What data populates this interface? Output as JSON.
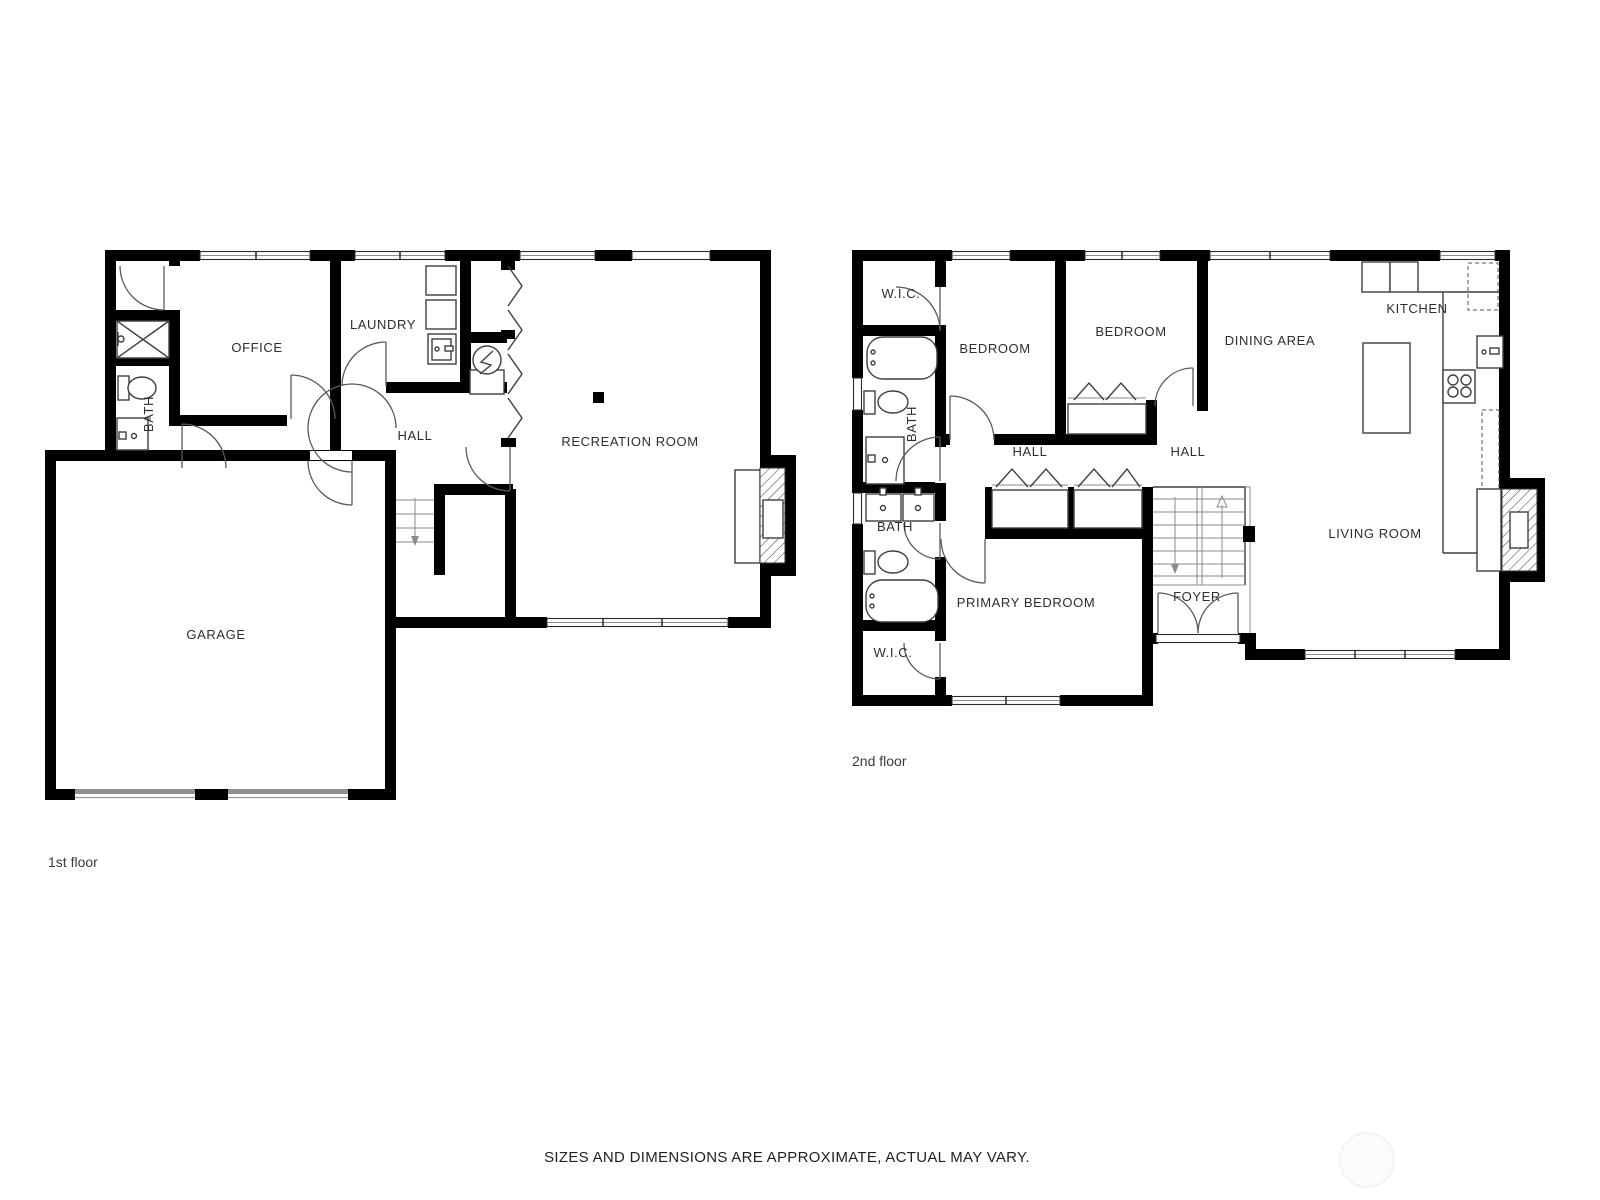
{
  "page": {
    "disclaimer": "SIZES AND DIMENSIONS ARE APPROXIMATE, ACTUAL MAY VARY.",
    "watermark": "faint-circle"
  },
  "colors": {
    "wall": "#000000",
    "fixture_line": "#3f3f3f",
    "door_arc": "#5a5a5a",
    "label_text": "#2e2e2e",
    "garage_door_gray": "#8f8f8f",
    "watermark_gray": "#f0f0f0"
  },
  "floor1": {
    "caption": "1st floor",
    "rooms": {
      "office": "OFFICE",
      "laundry": "LAUNDRY",
      "bath": "BATH",
      "hall": "HALL",
      "recreation": "RECREATION ROOM",
      "garage": "GARAGE"
    }
  },
  "floor2": {
    "caption": "2nd floor",
    "rooms": {
      "wic_top": "W.I.C.",
      "bedroom_left": "BEDROOM",
      "bedroom_right": "BEDROOM",
      "kitchen": "KITCHEN",
      "dining": "DINING AREA",
      "bath_upper": "BATH",
      "hall_left": "HALL",
      "hall_right": "HALL",
      "bath_lower": "BATH",
      "primary": "PRIMARY BEDROOM",
      "foyer": "FOYER",
      "living": "LIVING ROOM",
      "wic_bottom": "W.I.C."
    }
  }
}
